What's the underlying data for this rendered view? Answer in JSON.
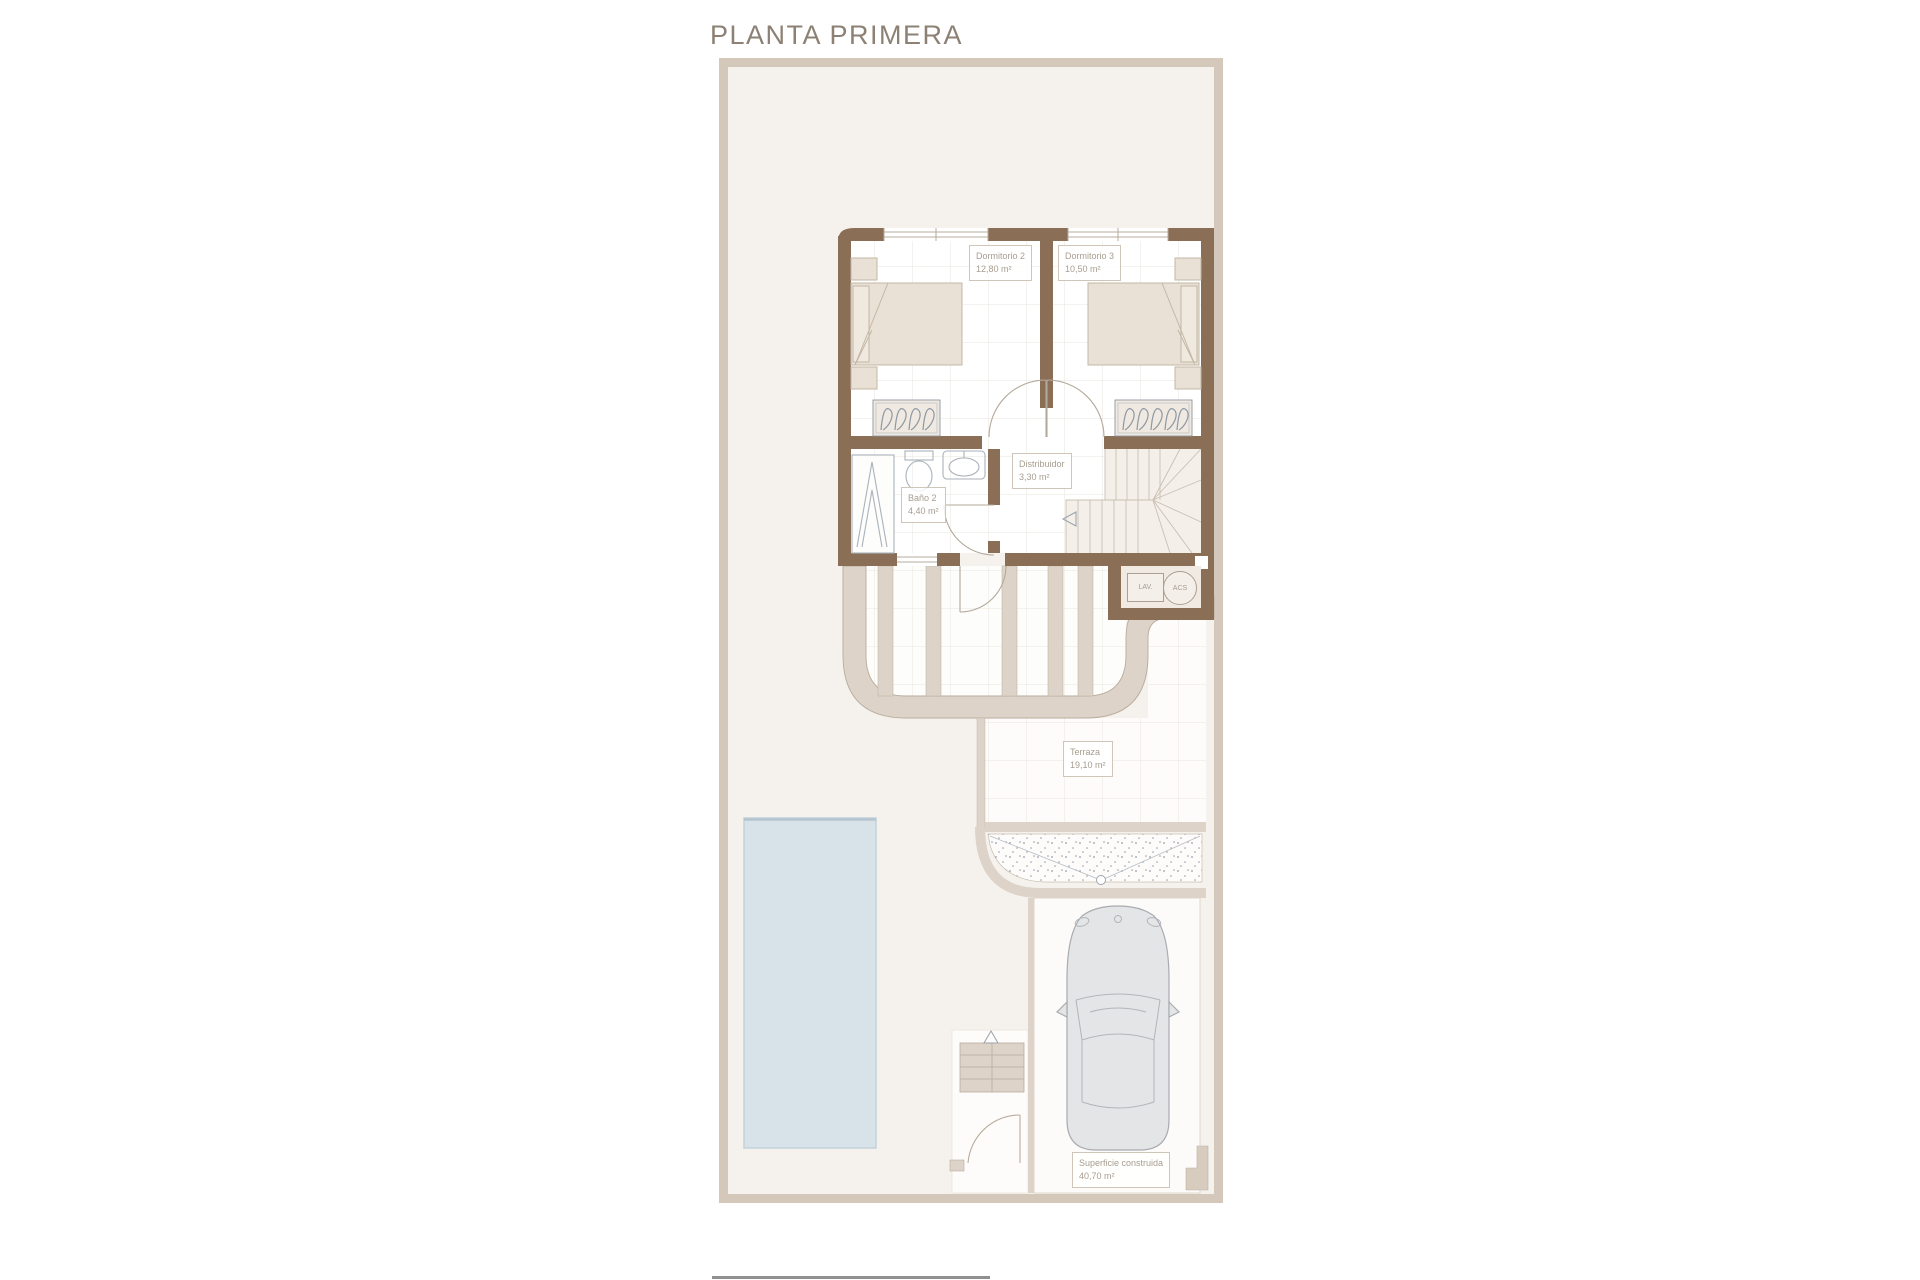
{
  "title": "PLANTA PRIMERA",
  "rooms": {
    "dormitorio2": {
      "name": "Dormitorio 2",
      "area": "12,80 m²"
    },
    "dormitorio3": {
      "name": "Dormitorio 3",
      "area": "10,50 m²"
    },
    "distribuidor": {
      "name": "Distribuidor",
      "area": "3,30 m²"
    },
    "bano2": {
      "name": "Baño 2",
      "area": "4,40 m²"
    },
    "terraza": {
      "name": "Terraza",
      "area": "19,10 m²"
    },
    "superficie": {
      "name": "Superficie construida",
      "area": "40,70 m²"
    }
  },
  "utilities": {
    "lav": "LAV.",
    "acs": "ACS"
  },
  "colors": {
    "wall_brown": "#8a6e55",
    "band_tan": "#ddd3c8",
    "plot_background": "#f5f2ee",
    "plot_border": "#d3c8ba",
    "pool_blue": "#d8e3e9",
    "label_text": "#a79d90",
    "title_text": "#8c8174",
    "fixture_gray": "#96a0aa",
    "car_gray": "#e4e5e7"
  }
}
